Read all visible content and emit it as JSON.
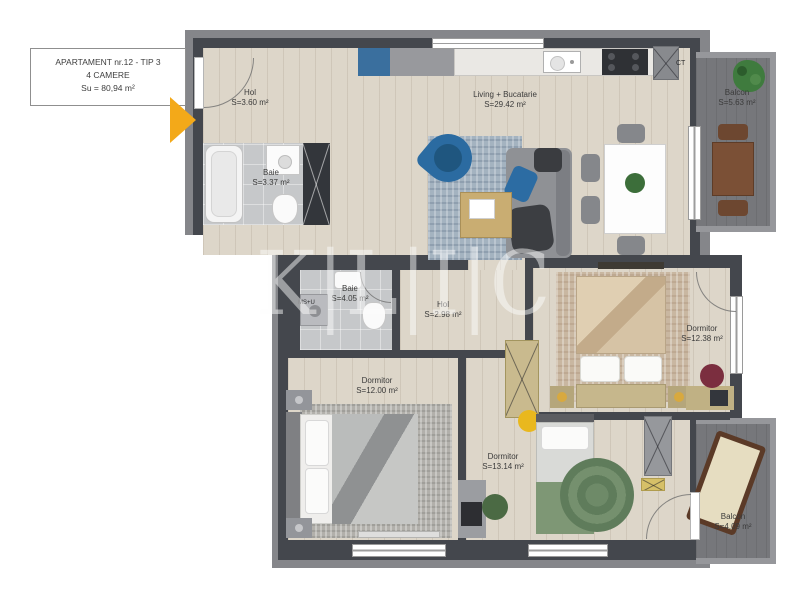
{
  "info_box": {
    "line1": "APARTAMENT nr.12 - TIP 3",
    "line2": "4 CAMERE",
    "line3": "Su = 80,94 m²"
  },
  "watermark": "K|L|I|C",
  "rooms": [
    {
      "id": "hol-1",
      "name": "Hol",
      "area": "S=3.60 m²"
    },
    {
      "id": "baie-1",
      "name": "Baie",
      "area": "S=3.37 m²"
    },
    {
      "id": "living-bucatarie",
      "name": "Living + Bucatarie",
      "area": "S=29.42 m²"
    },
    {
      "id": "balcon-1",
      "name": "Balcon",
      "area": "S=5.63 m²"
    },
    {
      "id": "baie-2",
      "name": "Baie",
      "area": "S=4.05 m²"
    },
    {
      "id": "hol-2",
      "name": "Hol",
      "area": "S=2.98 m²"
    },
    {
      "id": "dormitor-1",
      "name": "Dormitor",
      "area": "S=12.38 m²"
    },
    {
      "id": "dormitor-2",
      "name": "Dormitor",
      "area": "S=12.00 m²"
    },
    {
      "id": "dormitor-3",
      "name": "Dormitor",
      "area": "S=13.14 m²"
    },
    {
      "id": "balcon-2",
      "name": "Balcon",
      "area": "S=4.09 m²"
    }
  ],
  "annotations": {
    "boiler": "CT",
    "washer": "MS+U"
  },
  "colors": {
    "wall": "#44474d",
    "slab": "#85868a",
    "wood": "#ddd6c9",
    "tile": "#c6c8ca",
    "balcony_floor": "#76777b",
    "accent_arrow": "#f3a919",
    "watermark_color": "rgba(253,253,253,0.48)"
  }
}
